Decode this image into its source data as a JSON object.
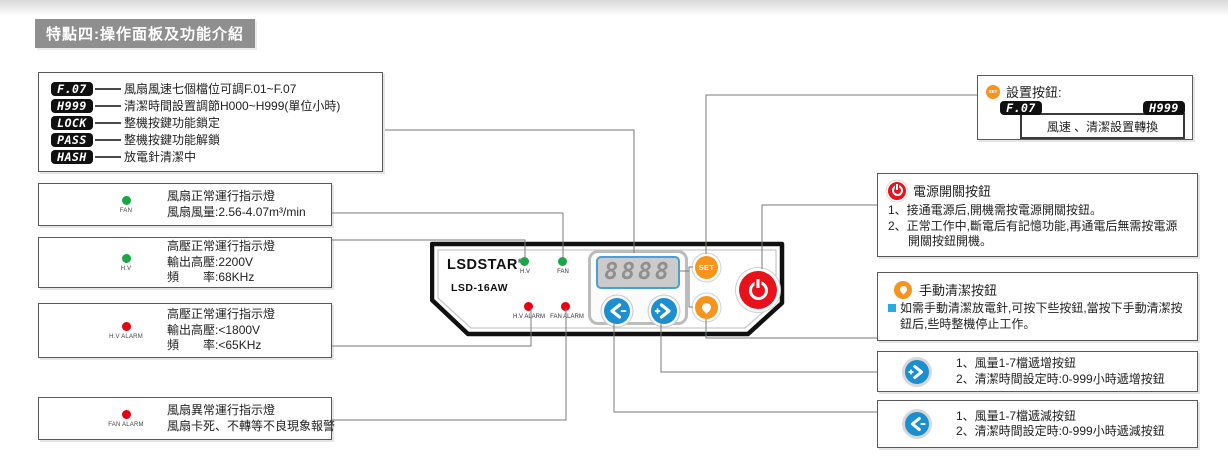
{
  "title_banner": "特點四:操作面板及功能介紹",
  "colors": {
    "green_led": "#17a845",
    "red_led": "#e60012",
    "orange_accent": "#f7941e",
    "blue_accent": "#1b8fd0",
    "display_border_blue": "#4a9fd8",
    "connector_line": "#7a7a7a"
  },
  "codes_box": {
    "rows": [
      {
        "badge": "F.07",
        "text": "風扇風速七個檔位可調F.01~F.07"
      },
      {
        "badge": "H999",
        "text": "清潔時間設置調節H000~H999(單位小時)"
      },
      {
        "badge": "LOCK",
        "text": "整機按鍵功能鎖定"
      },
      {
        "badge": "PASS",
        "text": "整機按鍵功能解鎖"
      },
      {
        "badge": "HASH",
        "text": "放電針清潔中"
      }
    ]
  },
  "fan_box": {
    "led_label": "FAN",
    "line1": "風扇正常運行指示燈",
    "line2": "風扇風量:2.56-4.07m³/min"
  },
  "hv_box": {
    "led_label": "H.V",
    "line1": "高壓正常運行指示燈",
    "line2": "輸出高壓:2200V",
    "line3": "頻　　率:68KHz"
  },
  "hv_alarm_box": {
    "led_label": "H.V ALARM",
    "line1": "高壓正常運行指示燈",
    "line2": "輸出高壓:<1800V",
    "line3": "頻　　率:<65KHz"
  },
  "fan_alarm_box": {
    "led_label": "FAN ALARM",
    "line1": "風扇異常運行指示燈",
    "line2": "風扇卡死、不轉等不良現象報警"
  },
  "panel": {
    "brand": "LSDSTAR",
    "reg": "®",
    "model": "LSD-16AW",
    "display_value": "8888",
    "led_hv": "H.V",
    "led_fan": "FAN",
    "led_hv_alarm": "H.V ALARM",
    "led_fan_alarm": "FAN ALARM",
    "set_label": "SET"
  },
  "set_box": {
    "icon_label": "SET",
    "title": "設置按鈕:",
    "badge_left": "F.07",
    "badge_right": "H999",
    "caption": "風速 、清潔設置轉換"
  },
  "power_box": {
    "title": "電源開關按鈕",
    "item1": "1、接通電源后,開機需按電源開關按鈕。",
    "item2": "2、正常工作中,斷電后有記憶功能,再通電后無需按電源開關按鈕開機。"
  },
  "clean_box": {
    "title": "手動清潔按鈕",
    "body": "如需手動清潔放電針,可按下些按鈕,當按下手動清潔按鈕后,些時整機停止工作。"
  },
  "increment_box": {
    "item1": "1、風量1-7檔遞增按鈕",
    "item2": "2、清潔時間設定時:0-999小時遞增按鈕"
  },
  "decrement_box": {
    "item1": "1、風量1-7檔遞減按鈕",
    "item2": "2、清潔時間設定時:0-999小時遞減按鈕"
  }
}
